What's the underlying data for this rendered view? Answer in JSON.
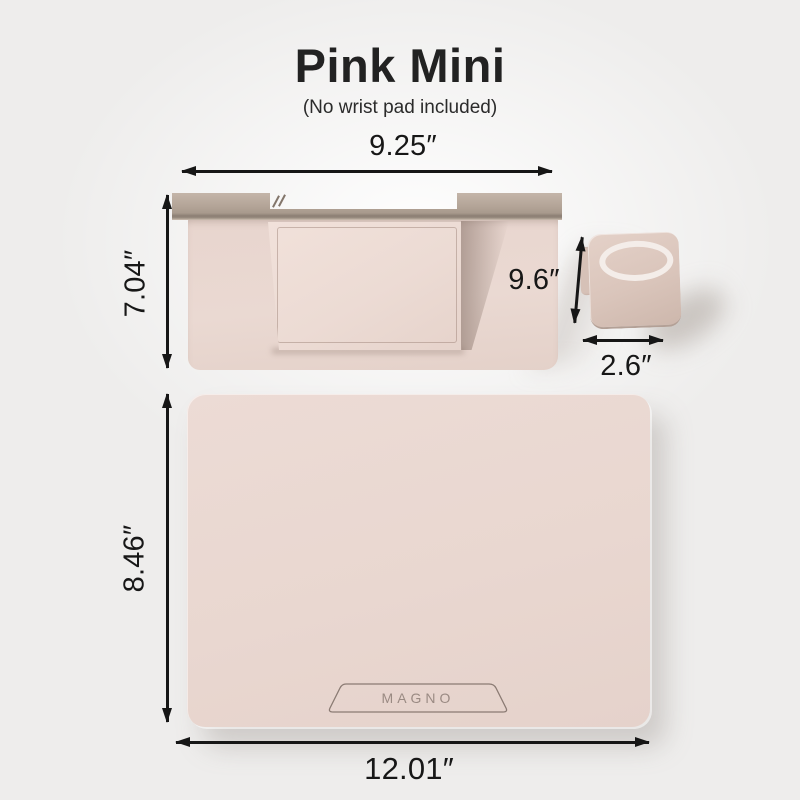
{
  "header": {
    "title": "Pink Mini",
    "subtitle": "(No wrist pad included)"
  },
  "keyboard": {
    "width": "9.25″",
    "height": "7.04″",
    "depth": "9.6″"
  },
  "phone_stand": {
    "width": "2.6″"
  },
  "mousepad": {
    "height": "8.46″",
    "width": "12.01″",
    "brand": "MAGNO"
  },
  "colors": {
    "background": "#eeedec",
    "pad_pink": "#e9d7d0",
    "bar_taupe": "#b0a296",
    "shadow_taupe": "#7a655b",
    "dimension_text": "#171717"
  }
}
